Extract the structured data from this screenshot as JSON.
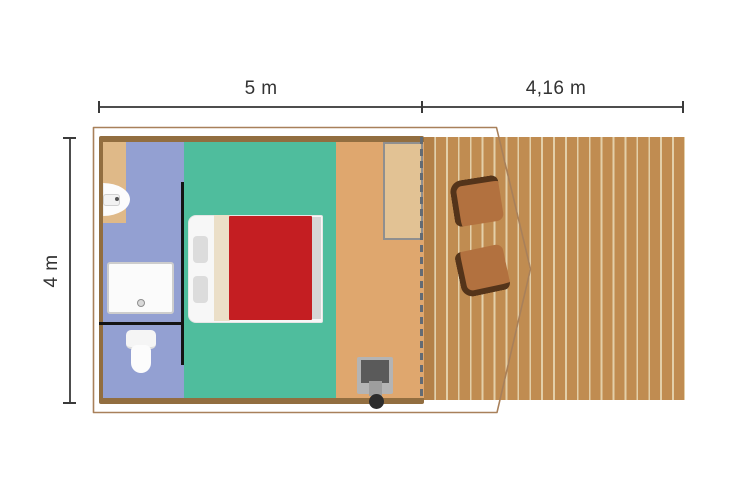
{
  "figure": {
    "name": "safari-tent-floor-plan",
    "description": "Top-view floor plan of a safari tent with bathroom, bedroom, wood stove and wooden terrace with two chairs"
  },
  "dimensions": {
    "tent_width": {
      "label": "5 m"
    },
    "terrace_width": {
      "label": "4,16 m"
    },
    "depth": {
      "label": "4 m"
    }
  },
  "rooms": [
    {
      "id": "bathroom",
      "color": "#93a0d2"
    },
    {
      "id": "bedroom",
      "color": "#4fbd9d"
    },
    {
      "id": "living-floor",
      "color": "#dfa76e"
    },
    {
      "id": "terrace-deck",
      "color": "#c08c51"
    }
  ],
  "furniture": [
    "washbasin",
    "shower-tray",
    "toilet",
    "double-bed",
    "wardrobe",
    "wood-stove",
    "deck-chair-1",
    "deck-chair-2"
  ],
  "colors": {
    "wall": "#926e40",
    "tent_canvas_outline": "#a8805a",
    "bed_duvet": "#c41e22",
    "bed_fold": "#ebdfc8",
    "deck_plank": "#c08c51",
    "deck_plank_gap": "#e3cfa9",
    "chair_seat": "#b2713f",
    "chair_back": "#54341a",
    "entrance_dash": "#636b74",
    "dimension_line": "#4d4d4d",
    "label_text": "#333333"
  }
}
